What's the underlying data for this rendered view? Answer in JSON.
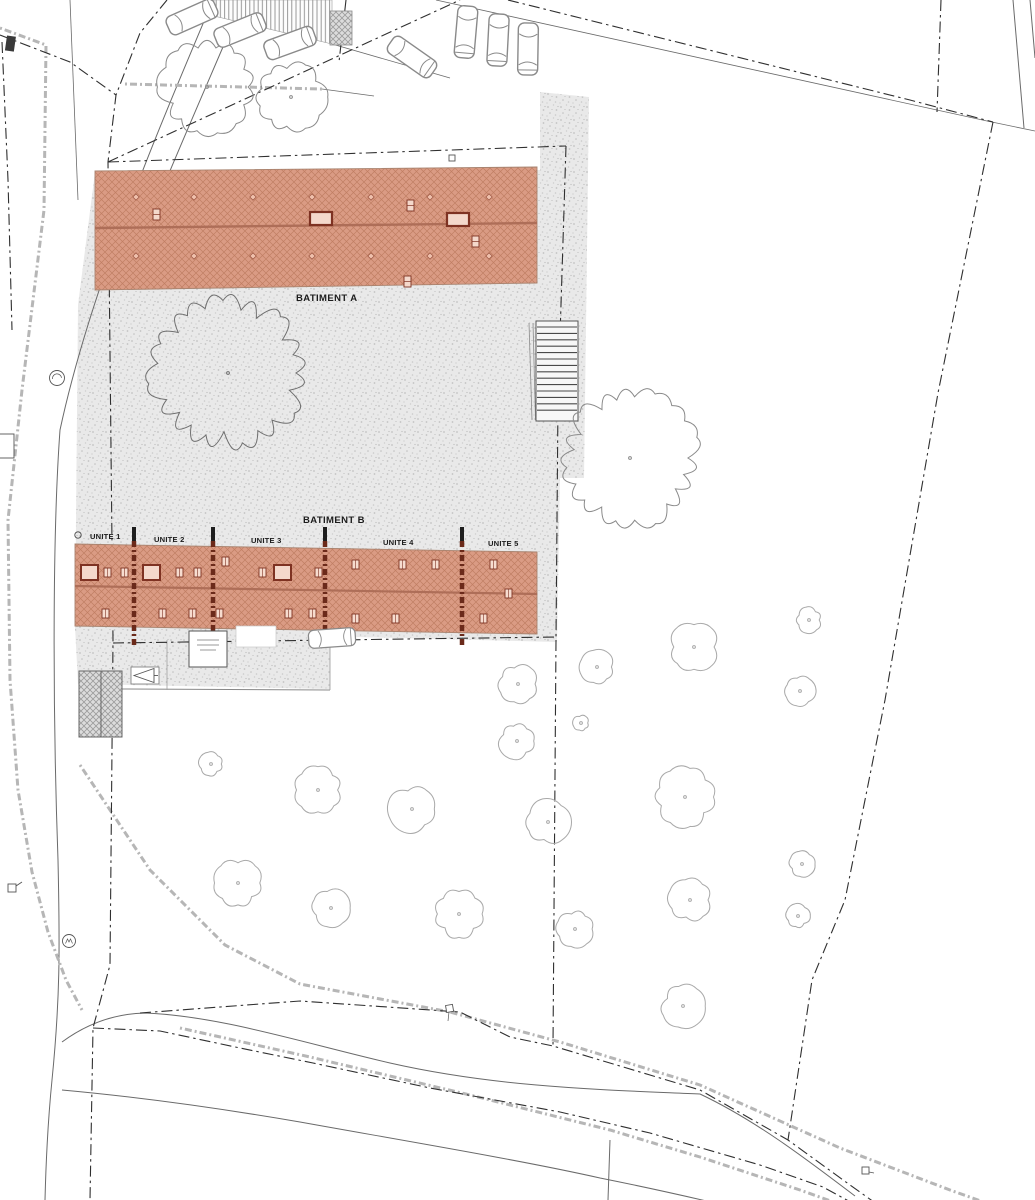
{
  "plan": {
    "labels": {
      "building_a": "BATIMENT A",
      "building_b": "BATIMENT B"
    },
    "units": [
      {
        "label": "UNITE 1"
      },
      {
        "label": "UNITE 2"
      },
      {
        "label": "UNITE 3"
      },
      {
        "label": "UNITE 4"
      },
      {
        "label": "UNITE 5"
      }
    ],
    "colors": {
      "roof_fill": "#DA9B84",
      "roof_hatch": "#A9573C",
      "roof_ridge": "#AE6E58",
      "roof_detail": "#7E3222",
      "unit_divider": "#6B2A1A",
      "paving_base": "#E9E9E9",
      "paving_dot": "#C2C2C2",
      "boundary_line": "#2F2F2F",
      "utility_dotted": "#B6B6B6",
      "tree_outline": "#8A8A8A"
    }
  }
}
